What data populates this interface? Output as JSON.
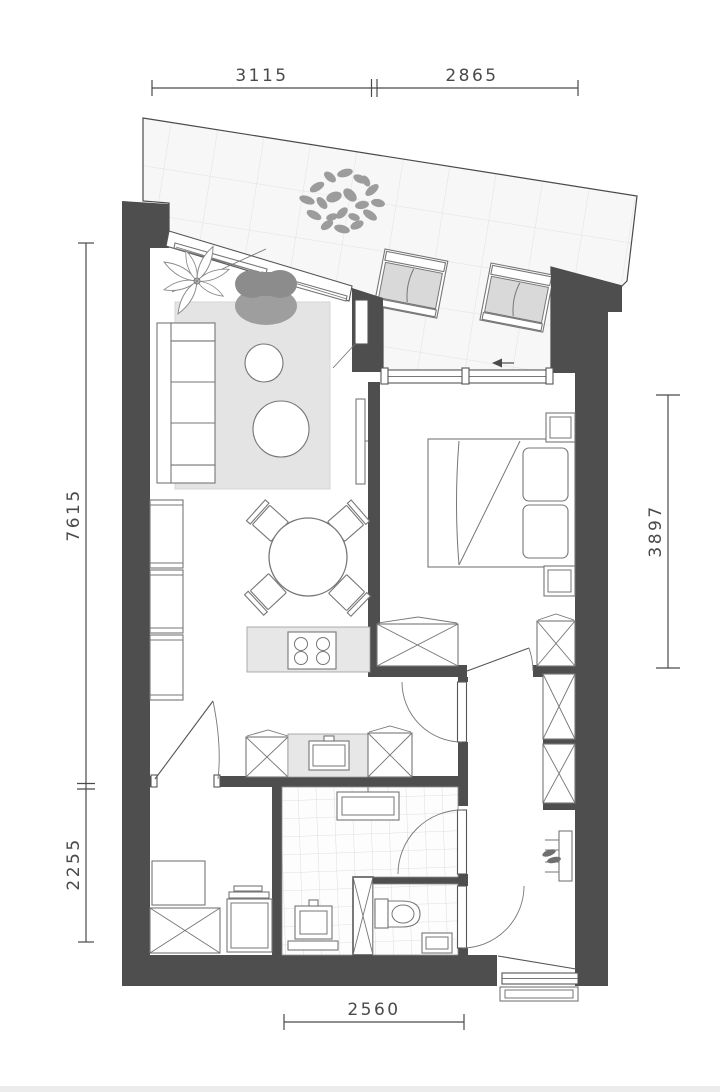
{
  "title": "apartment-floor-plan",
  "dimensions_mm": {
    "top": [
      "3115",
      "2865"
    ],
    "left": [
      "7615",
      "2255"
    ],
    "right": [
      "3897"
    ],
    "bottom": [
      "2560"
    ]
  },
  "colors": {
    "wall": "#4e4e4e",
    "line": "#767676",
    "structure_line": "#4a4a4a",
    "dim_text": "#4a4a4a",
    "rug": "#e4e4e4",
    "counter": "#e7e7e7",
    "cushion": "#d9d9d9",
    "armchair_back": "#8c8c8c",
    "armchair_seat": "#9e9e9e",
    "foliage": "#9c9c9c",
    "balcony_tile_bg": "#f7f7f7",
    "balcony_tile_line": "#e2e2e2",
    "bath_tile_line": "#d6d6d6",
    "footer_strip": "#ececec"
  },
  "rooms": [
    "balcony",
    "living-room",
    "dining-area",
    "kitchen",
    "bedroom",
    "hallway",
    "bathroom",
    "toilet",
    "storage",
    "entry"
  ],
  "furniture_symbols": [
    "sofa",
    "rug",
    "armchair",
    "coffee-table",
    "potted-plant",
    "shrub",
    "sun-lounger",
    "tv",
    "shelving-unit",
    "dining-table",
    "dining-chair",
    "cooktop",
    "kitchen-sink",
    "cabinet",
    "bed",
    "nightstand",
    "wardrobe",
    "closet",
    "coat-rack",
    "radiator",
    "washbasin",
    "toilet-bowl",
    "hand-basin",
    "washing-machine",
    "doormat",
    "door-swing",
    "sliding-window"
  ]
}
